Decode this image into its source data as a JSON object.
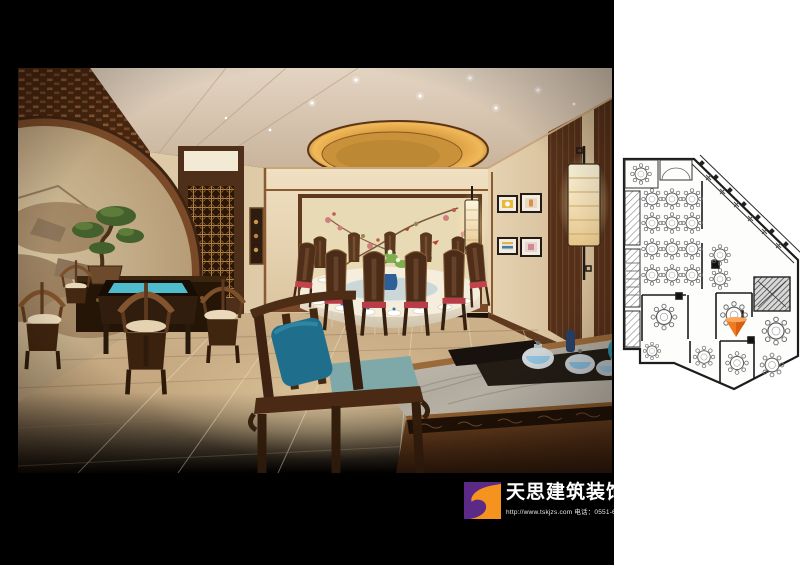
{
  "watermark": {
    "brand": "天思建筑装饰",
    "contact_line": "http://www.tskjzs.com 电话：0551-65568226"
  },
  "colors": {
    "logo_purple": "#5b2a86",
    "logo_orange": "#f6921e",
    "plan_marker": "#ee7b21",
    "wall_cream": "#ead8ba",
    "wood_dark": "#4a2a14",
    "cove_glow": "#e0a648",
    "cushion_red": "#c2424d",
    "cushion_teal": "#1f6e8c",
    "table_cyan": "#52c6d8"
  },
  "rendering": {
    "scene_elements": [
      "ceiling-cove-light",
      "chandelier",
      "moon-gate-lattice-wall",
      "landscape-mural",
      "bonsai",
      "square-tea-table",
      "horseshoe-armchairs",
      "round-banquet-table",
      "red-cushion-chairs",
      "flower-bird-mural",
      "door-with-lattice",
      "wall-art-frames",
      "wall-sconces",
      "marble-coffee-table",
      "tea-set",
      "foreground-armchair",
      "marble-floor"
    ]
  },
  "floor_plan": {
    "hall_round_tables": 12,
    "private_room_tables": 7,
    "marker": "highlighted-room-arrow"
  }
}
